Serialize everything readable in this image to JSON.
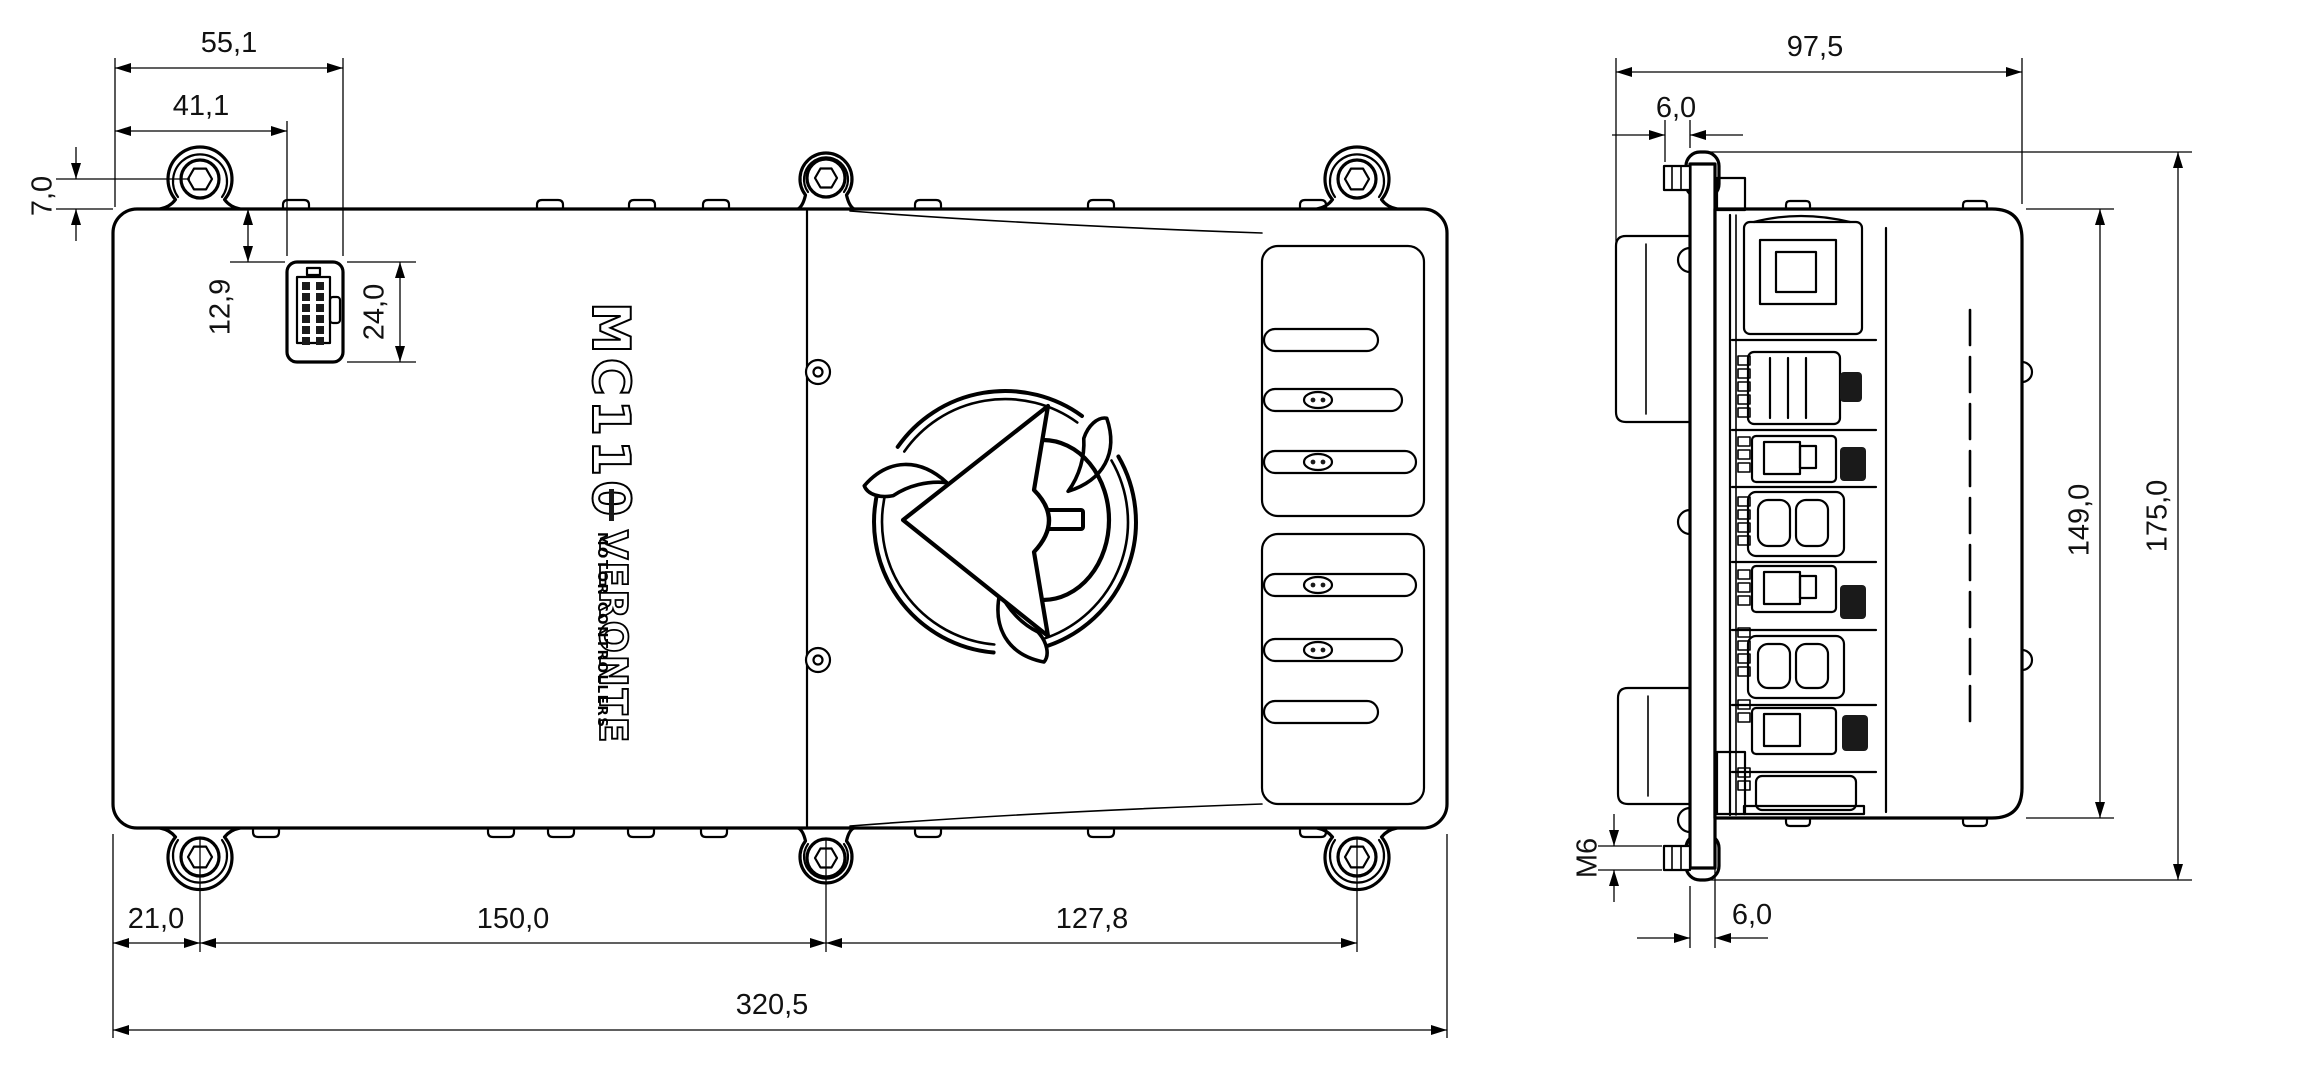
{
  "page": {
    "background": "#ffffff",
    "line_color": "#000000",
    "text_color": "#111111"
  },
  "logo": {
    "model": "MC110",
    "separator": "|",
    "brand": "VERONTE",
    "tagline": "MOTOR CONTROLLERS"
  },
  "dimensions": {
    "top_view": {
      "connector_right_offset": "55,1",
      "connector_left_offset": "41,1",
      "hole_center_to_edge": "7,0",
      "edge_to_connector": "12,9",
      "connector_height": "24,0",
      "edge_to_first_hole": "21,0",
      "hole_pitch_left": "150,0",
      "hole_pitch_right": "127,8",
      "overall_length": "320,5"
    },
    "side_view": {
      "overall_depth": "97,5",
      "stud_length": "6,0",
      "flange_thickness": "6,0",
      "body_height": "149,0",
      "overall_height": "175,0",
      "thread_callout": "M6"
    }
  }
}
